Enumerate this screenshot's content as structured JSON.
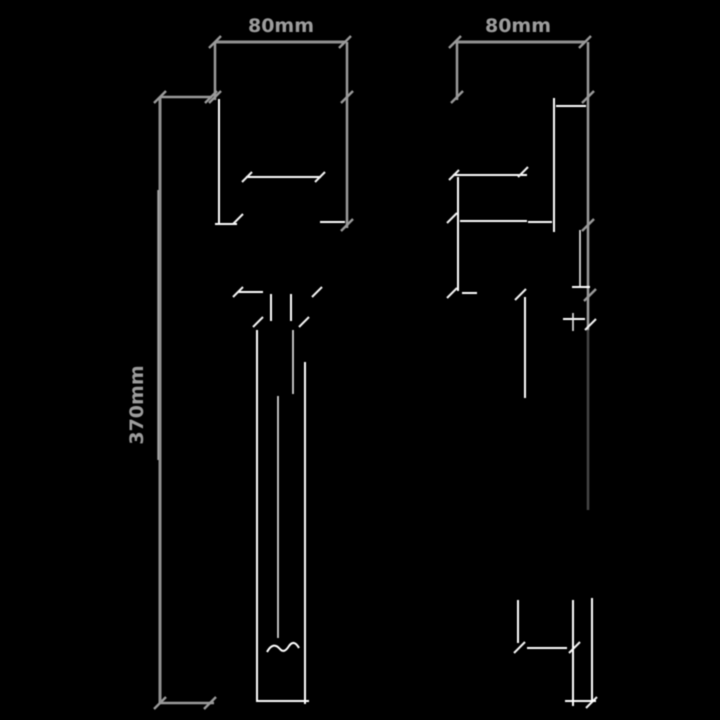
{
  "diagram": {
    "kind": "technical-dimension-drawing",
    "background_color": "#000000",
    "colors": {
      "dimension_line": "#8f8f8f",
      "dimension_text": "#9c9c9c",
      "outline_fragment": "#ffffff"
    },
    "views": {
      "front": {
        "label": "front-view",
        "width_label": "80mm",
        "height_label": "370mm"
      },
      "side": {
        "label": "side-view",
        "depth_label": "80mm"
      }
    }
  }
}
